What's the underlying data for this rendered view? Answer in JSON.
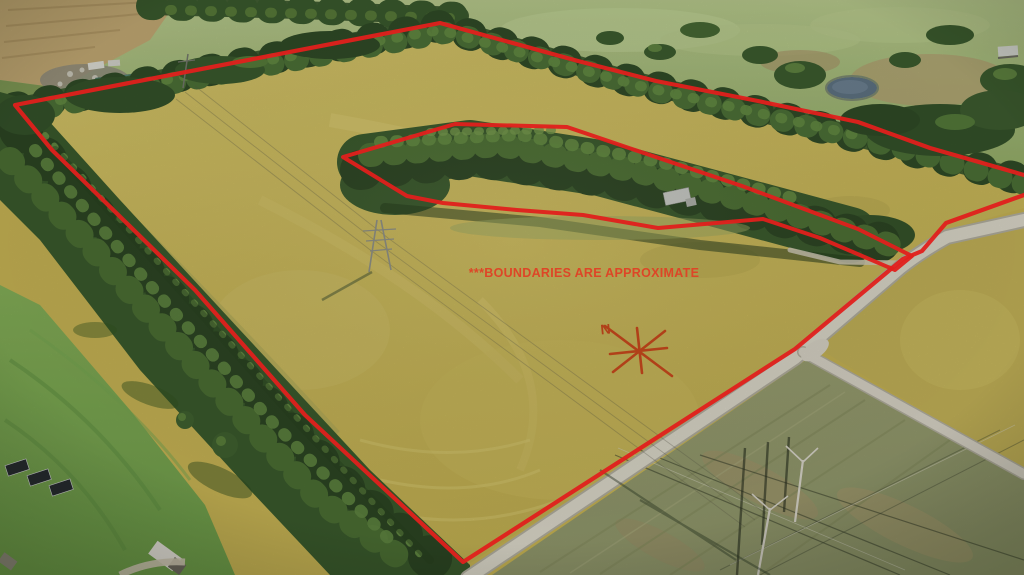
{
  "overlay": {
    "disclaimer_text": "***BOUNDARIES ARE APPROXIMATE",
    "disclaimer_x": 584,
    "disclaimer_y": 277,
    "compass_label": "N",
    "compass_label_x": 606,
    "compass_label_y": 334,
    "compass_transform": "translate(639,351)",
    "line_color": "#e0201c",
    "text_color": "#dd4627",
    "compass_color": "#b04019",
    "outer_boundary_points": "1024,175 930,148 858,122 758,101 656,81 578,61 440,23 15,105 52,150 195,290 305,415 463,562 795,349 903,259 922,251 946,223 1024,195",
    "exclusion_boundary_points": "343,157 455,124 567,127 632,149 742,186 858,229 912,256 895,270 820,238 763,219 658,228 583,215 517,210 443,203 407,196"
  }
}
